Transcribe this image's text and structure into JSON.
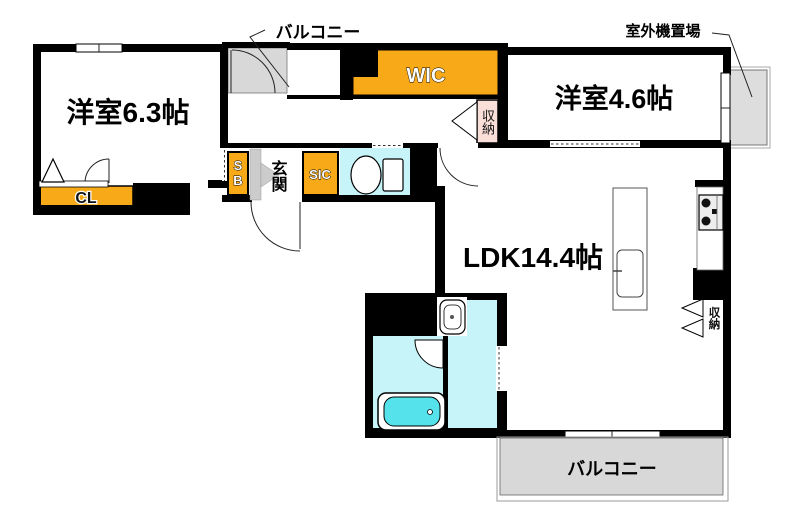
{
  "labels": {
    "balcony_top": "バルコニー",
    "outdoor_unit_area": "室外機置場",
    "bedroom1": "洋室6.3帖",
    "bedroom2": "洋室4.6帖",
    "wic": "WIC",
    "hall_storage": "収納",
    "shoe_box": "SB",
    "entrance": "玄関",
    "sic": "SIC",
    "closet": "CL",
    "ldk": "LDK14.4帖",
    "kitchen_storage": "収納",
    "balcony_bottom": "バルコニー"
  },
  "colors": {
    "wall": "#000000",
    "accent_orange": "#F7A918",
    "storage_pink": "#FADFD9",
    "water_cyan": "#C7F4F8",
    "bathtub_cyan": "#55E2EB",
    "balcony_gray": "#D8D8D8",
    "outdoor_unit_gray": "#DDDDDD",
    "entrance_step_gray": "#CCCCCC"
  }
}
